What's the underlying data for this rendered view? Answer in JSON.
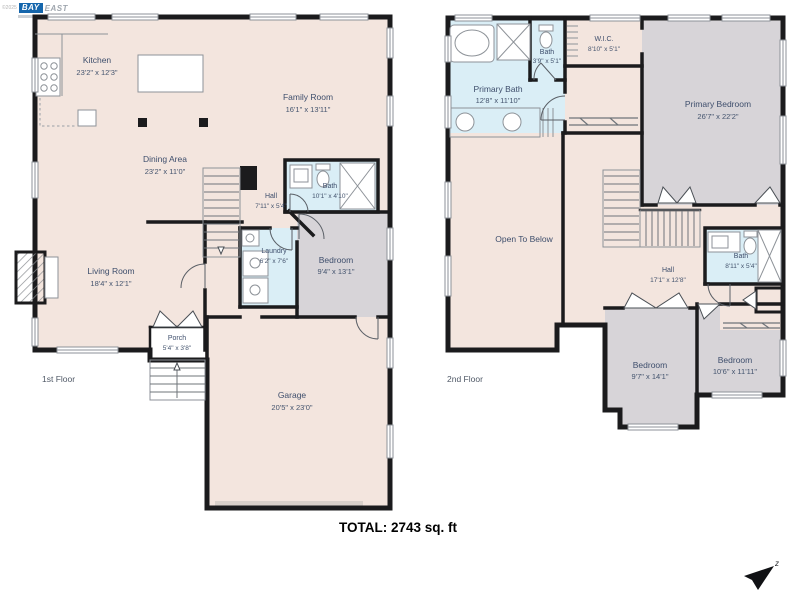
{
  "logo": {
    "copyright": "©2025",
    "bay": "BAY",
    "east": "EAST"
  },
  "total_label": "TOTAL: 2743 sq. ft",
  "compass": {
    "label": "z"
  },
  "floors": {
    "first": {
      "label": "1st Floor",
      "rooms": {
        "kitchen": {
          "name": "Kitchen",
          "dims": "23'2\" x 12'3\""
        },
        "family": {
          "name": "Family Room",
          "dims": "16'1\" x 13'11\""
        },
        "dining": {
          "name": "Dining Area",
          "dims": "23'2\" x 11'0\""
        },
        "hall": {
          "name": "Hall",
          "dims": "7'11\" x 5'4\""
        },
        "bath": {
          "name": "Bath",
          "dims": "10'1\" x 4'10\""
        },
        "laundry": {
          "name": "Laundry",
          "dims": "6'2\" x 7'6\""
        },
        "bedroom": {
          "name": "Bedroom",
          "dims": "9'4\" x 13'1\""
        },
        "living": {
          "name": "Living Room",
          "dims": "18'4\" x 12'1\""
        },
        "porch": {
          "name": "Porch",
          "dims": "5'4\" x 3'8\""
        },
        "garage": {
          "name": "Garage",
          "dims": "20'5\" x 23'0\""
        }
      }
    },
    "second": {
      "label": "2nd Floor",
      "rooms": {
        "primary_bath": {
          "name": "Primary Bath",
          "dims": "12'8\" x 11'10\""
        },
        "bath_small": {
          "name": "Bath",
          "dims": "3'9\" x 5'1\""
        },
        "wic": {
          "name": "W.I.C.",
          "dims": "8'10\" x 5'1\""
        },
        "primary_bedroom": {
          "name": "Primary Bedroom",
          "dims": "26'7\" x 22'2\""
        },
        "open_below": {
          "name": "Open To Below",
          "dims": ""
        },
        "hall": {
          "name": "Hall",
          "dims": "17'1\" x 12'8\""
        },
        "bath": {
          "name": "Bath",
          "dims": "8'11\" x 5'4\""
        },
        "bedroom_left": {
          "name": "Bedroom",
          "dims": "9'7\" x 14'1\""
        },
        "bedroom_right": {
          "name": "Bedroom",
          "dims": "10'6\" x 11'11\""
        }
      }
    }
  },
  "colors": {
    "wall": "#1b1b1d",
    "floor": "#f3e5de",
    "carpet": "#d7d4d8",
    "tile": "#daeef6",
    "label": "#3e4e6c"
  }
}
